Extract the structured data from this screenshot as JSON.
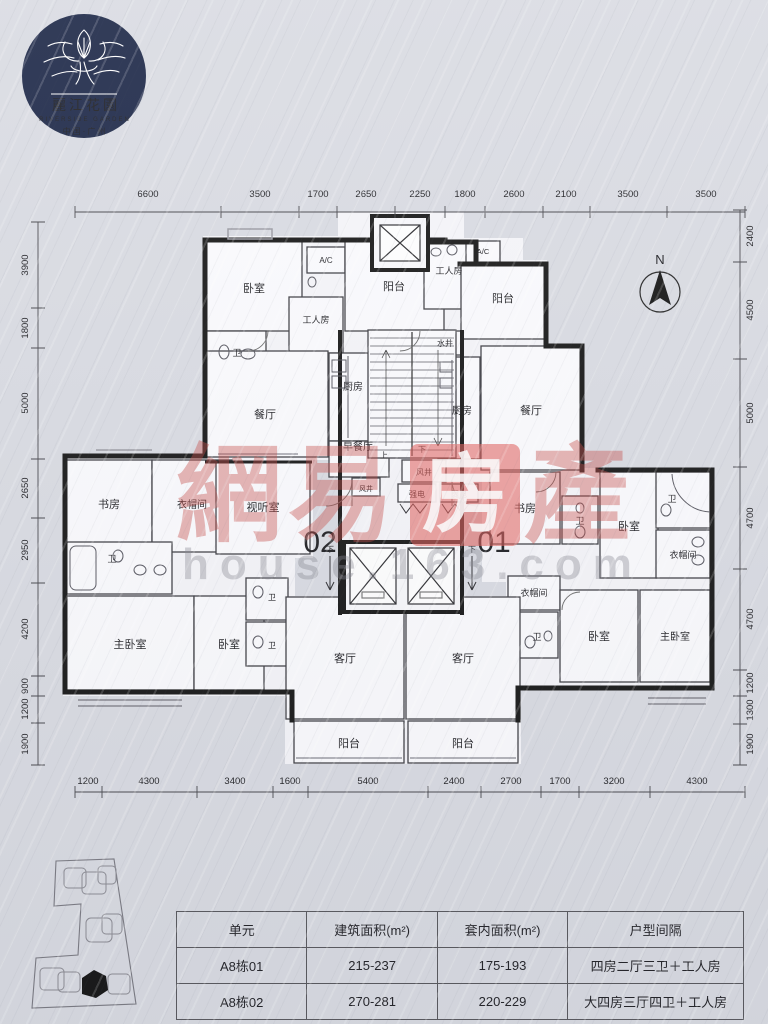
{
  "logo": {
    "cn": "麗江花園",
    "en": "RIVERSIDE GARDEN",
    "loc": "中国·广州"
  },
  "compass": {
    "label": "N"
  },
  "units": {
    "left": "02",
    "right": "01"
  },
  "watermark": {
    "c1": "網",
    "c2": "易",
    "c3": "房",
    "c4": "產",
    "sub": "house.163.com"
  },
  "rooms": {
    "bedroom": "卧室",
    "master": "主卧室",
    "living": "客厅",
    "dining": "餐厅",
    "kitchen": "厨房",
    "balcony": "阳台",
    "worker": "工人房",
    "study": "书房",
    "cloak": "衣帽间",
    "av": "视听室",
    "breakfast": "早餐厅",
    "bath": "卫",
    "ac": "A/C",
    "water": "水井",
    "wind": "风井",
    "strong": "强电",
    "weak": "弱电",
    "up": "上",
    "down": "下"
  },
  "dims": {
    "top": [
      "6600",
      "3500",
      "1700",
      "2650",
      "2250",
      "1800",
      "2600",
      "2100",
      "3500",
      "3500"
    ],
    "bottom": [
      "1200",
      "4300",
      "3400",
      "1600",
      "5400",
      "2400",
      "2700",
      "1700",
      "3200",
      "4300"
    ],
    "left": [
      "3900",
      "1800",
      "5000",
      "2650",
      "2950",
      "4200",
      "900",
      "1200",
      "1900"
    ],
    "right": [
      "2400",
      "4500",
      "5000",
      "4700",
      "4700",
      "1200",
      "1300",
      "1900"
    ]
  },
  "table": {
    "headers": [
      "单元",
      "建筑面积(m²)",
      "套内面积(m²)",
      "户型间隔"
    ],
    "rows": [
      [
        "A8栋01",
        "215-237",
        "175-193",
        "四房二厅三卫＋工人房"
      ],
      [
        "A8栋02",
        "270-281",
        "220-229",
        "大四房三厅四卫＋工人房"
      ]
    ]
  }
}
